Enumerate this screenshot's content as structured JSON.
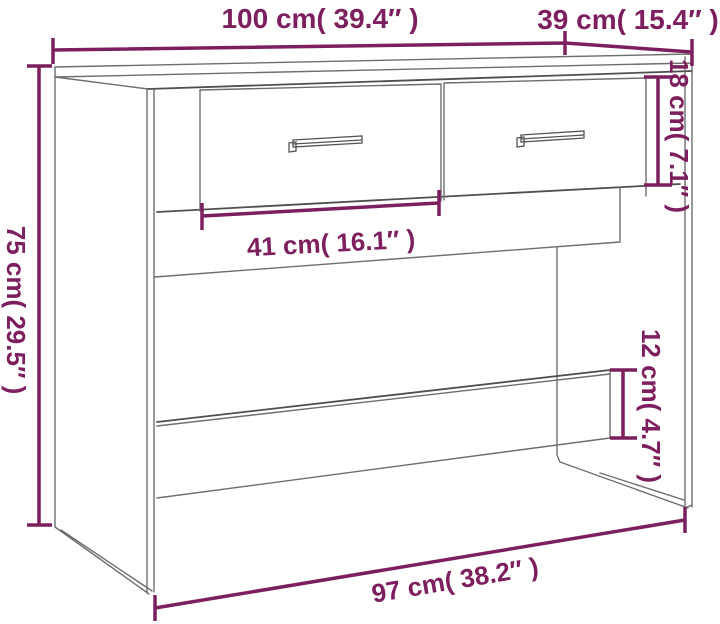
{
  "diagram": {
    "subject": "console table with two drawers",
    "style": {
      "accent_color": "#7d1f5e",
      "outline_color": "#6e6e6e",
      "background": "#ffffff"
    },
    "labels": {
      "top_width": "100 cm( 39.4″ )",
      "top_depth": "39 cm( 15.4″ )",
      "drawer_height": "18 cm( 7.1″ )",
      "overall_height": "75 cm( 29.5″ )",
      "drawer_width": "41 cm( 16.1″ )",
      "bottom_rail_height": "12 cm( 4.7″ )",
      "base_width": "97 cm( 38.2″ )"
    },
    "measurements": [
      {
        "name": "top width",
        "cm": 100,
        "inches": 39.4
      },
      {
        "name": "top depth",
        "cm": 39,
        "inches": 15.4
      },
      {
        "name": "drawer front height",
        "cm": 18,
        "inches": 7.1
      },
      {
        "name": "overall height",
        "cm": 75,
        "inches": 29.5
      },
      {
        "name": "drawer width",
        "cm": 41,
        "inches": 16.1
      },
      {
        "name": "bottom rail height",
        "cm": 12,
        "inches": 4.7
      },
      {
        "name": "base width",
        "cm": 97,
        "inches": 38.2
      }
    ]
  }
}
